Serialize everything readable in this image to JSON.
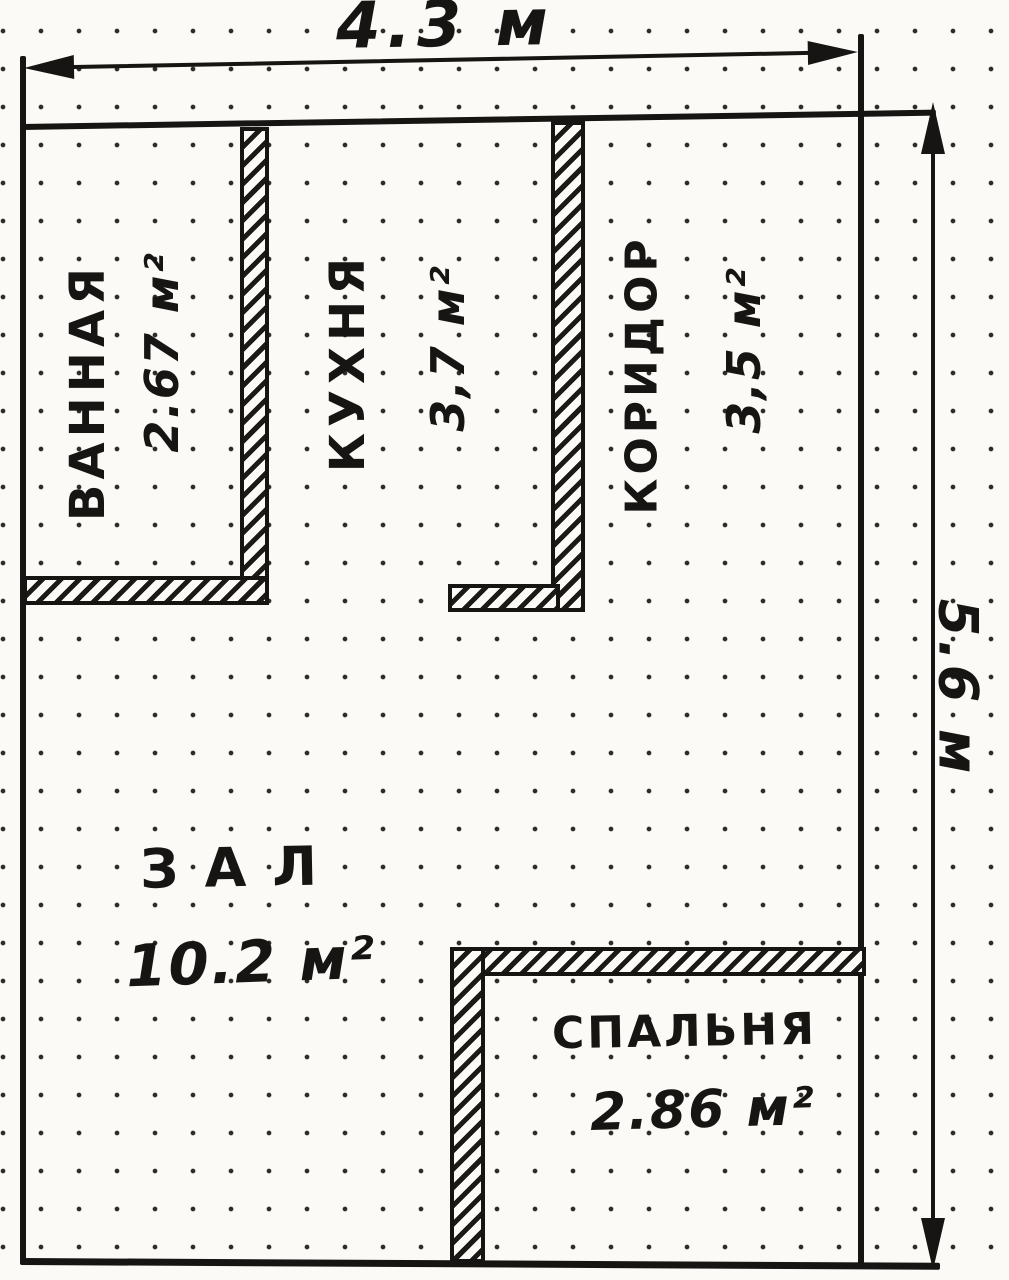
{
  "drawing": {
    "type": "hand-drawn apartment floor plan on dotted paper",
    "width_dimension": "4.3 м",
    "height_dimension": "5.6 м",
    "rooms": {
      "bathroom": {
        "name": "ВАННАЯ",
        "area": "2.67 м²"
      },
      "kitchen": {
        "name": "КУХНЯ",
        "area": "3,7 м²"
      },
      "corridor": {
        "name": "КОРИДОР",
        "area": "3,5 м²"
      },
      "hall": {
        "name": "ЗАЛ",
        "area": "10.2 м²"
      },
      "bedroom": {
        "name": "СПАЛЬНЯ",
        "area": "2.86 м²"
      }
    },
    "colors": {
      "ink": "#171513",
      "paper": "#fbfaf6"
    }
  }
}
